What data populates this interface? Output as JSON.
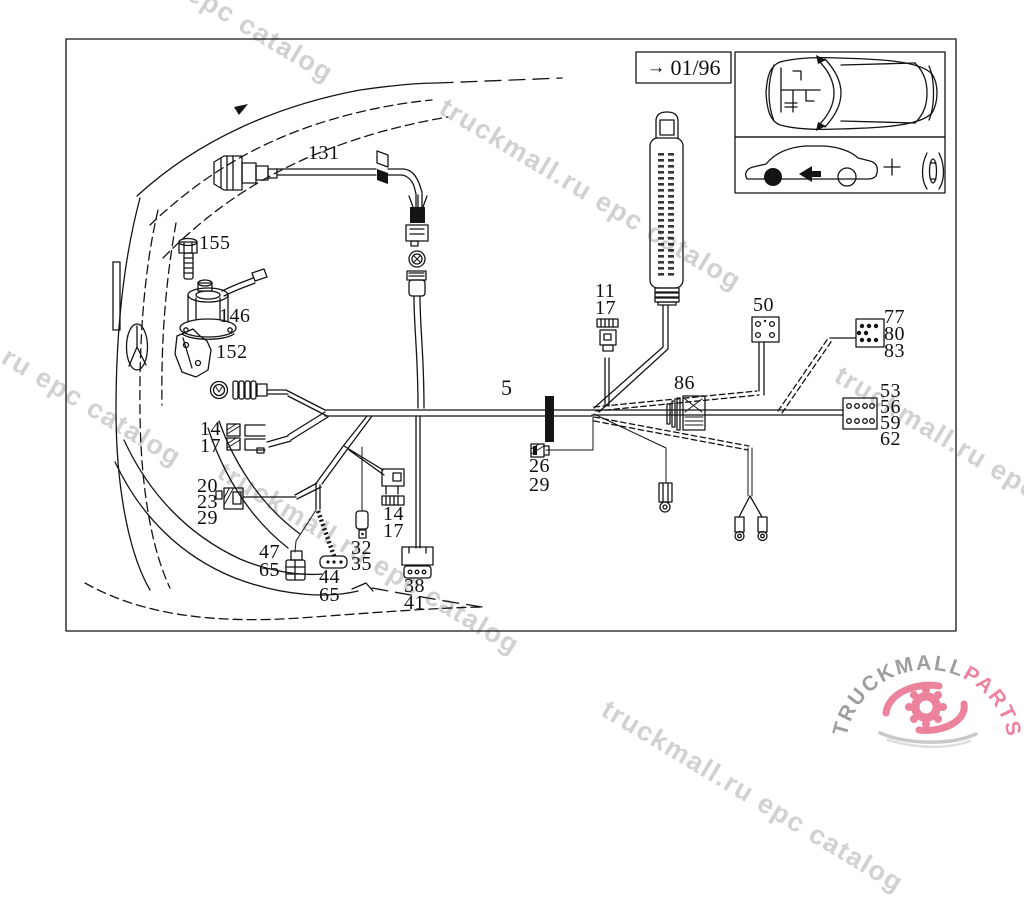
{
  "revision_box": {
    "arrow": "→",
    "revision": "01/96"
  },
  "watermark": {
    "text": "truckmall.ru epc catalog",
    "color": "#c6c6c6"
  },
  "callouts": {
    "part131": [
      "131"
    ],
    "part155": [
      "155"
    ],
    "part146": [
      "146"
    ],
    "part152": [
      "152"
    ],
    "conn14_17_left": [
      "14",
      "17"
    ],
    "conn20_23_29": [
      "20",
      "23",
      "29"
    ],
    "conn47_65": [
      "47",
      "65"
    ],
    "conn44_65": [
      "44",
      "65"
    ],
    "conn32_35": [
      "32",
      "35"
    ],
    "conn14_17_mid": [
      "14",
      "17"
    ],
    "conn38_41": [
      "38",
      "41"
    ],
    "harness_main": [
      "5"
    ],
    "conn26_29": [
      "26",
      "29"
    ],
    "conn11_17": [
      "11",
      "17"
    ],
    "conn86": [
      "86"
    ],
    "conn50": [
      "50"
    ],
    "conn77_80_83": [
      "77",
      "80",
      "83"
    ],
    "conn53_56_59_62": [
      "53",
      "56",
      "59",
      "62"
    ]
  },
  "logo": {
    "brand": "TRUCKMALL",
    "accent": "PARTS",
    "brand_color": "#9e9e9e",
    "accent_color": "#ec829b"
  },
  "colors": {
    "line": "#141414",
    "background": "#ffffff"
  }
}
